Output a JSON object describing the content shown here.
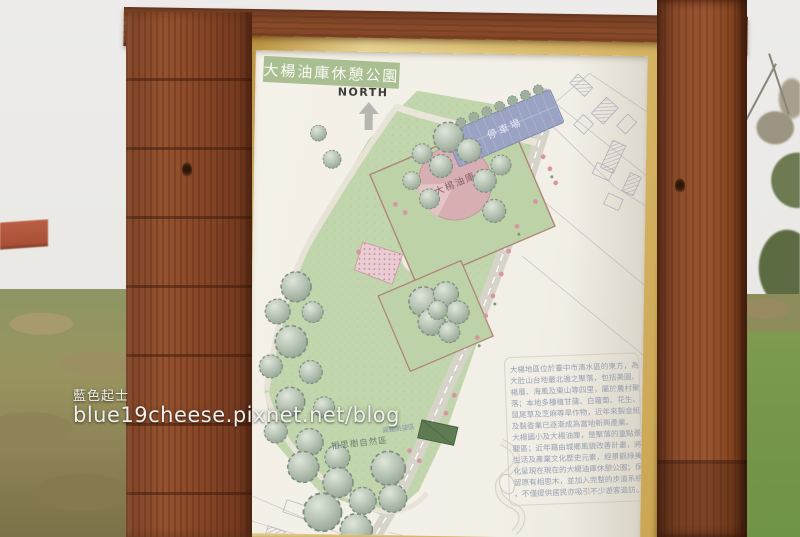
{
  "watermark": {
    "name": "藍色起士",
    "url": "blue19cheese.pixnet.net/blog"
  },
  "map": {
    "title": "大楊油庫休憩公園",
    "north_label": "NORTH",
    "labels": {
      "parking": "停車場",
      "oil_depot": "大楊油庫",
      "acacia_area": "相思樹自然區",
      "viewing_area": "高鐵眺望區",
      "road_name": "南清路"
    },
    "description_lines": [
      "大楊地區位於臺中市清水區的東方，為",
      "大肚山台地最北邊之聚落，包括美圓、",
      "楊厝、海風及東山等四里，屬於農村聚",
      "落；本地多種植甘藷、白蘿蔔、花生、",
      "鼠尾草及芝麻等旱作物，近年來製金紙",
      "及製香業已逐漸成為當地新興產業。",
      "大楊國小及大楊油庫，是聚落的重點景",
      "觀區；近年藉由城鄉風貌改善計畫，將",
      "生活及產業文化歷史元素，經景觀綠美",
      "化呈現在現在的大楊油庫休憩公園；保",
      "留原有相思木，並加入完整的步道系統",
      "，不僅提供居民亦吸引不少遊客造訪。"
    ],
    "colors": {
      "wood_frame": "#8a4a2a",
      "inner_frame_tan": "#dcbd6e",
      "panel": "#f2efe7",
      "title_banner_green": "#a9bf92",
      "lawn_green": "#c1d6ac",
      "parking_blue": "#9aa3c3",
      "oil_depot_pink": "#d7afb3",
      "description_text": "#99a1b3"
    }
  }
}
